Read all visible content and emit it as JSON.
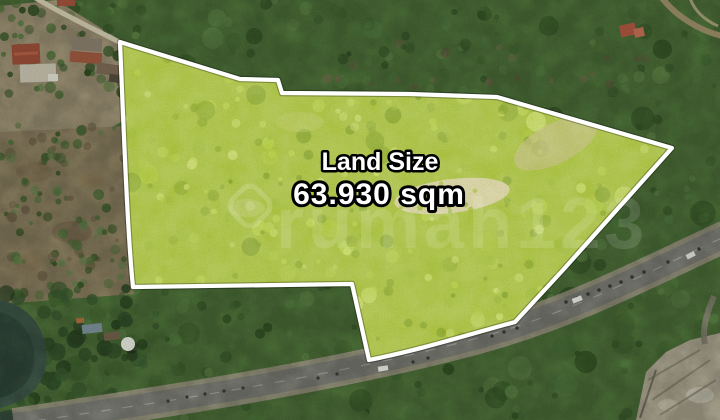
{
  "overlay": {
    "label": "Land Size",
    "value": "63.930 sqm"
  },
  "watermark": {
    "brand": "rumah123",
    "icon": "location-pin-icon"
  },
  "colors": {
    "boundary": "#ffffff",
    "plot_fill": "#aec839",
    "forest": "#4f7838",
    "road": "#8d8c86",
    "overlay_text": "#ffffff",
    "overlay_outline": "#000000"
  }
}
